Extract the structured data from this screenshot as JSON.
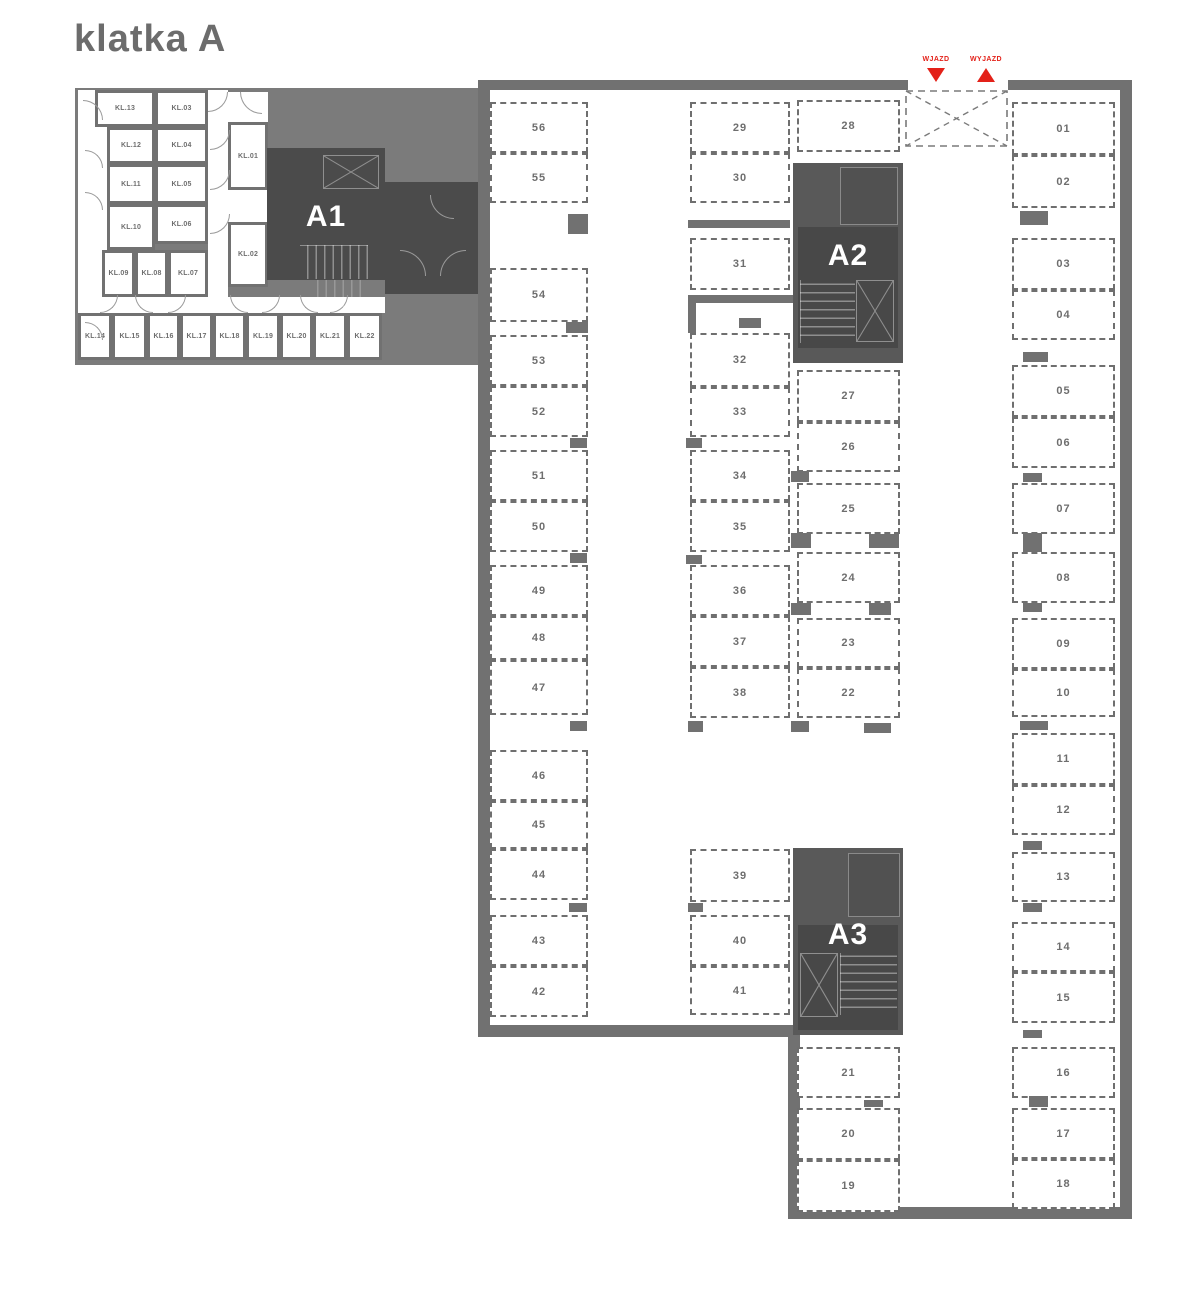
{
  "title": "klatka A",
  "colors": {
    "wall": "#717171",
    "background_region": "#7b7b7b",
    "dark_block": "#4b4b4b",
    "mid_block": "#595959",
    "label_text": "#6e6e6e",
    "accent_red": "#e32119",
    "white": "#ffffff"
  },
  "entrance": {
    "entry_label": "WJAZD",
    "exit_label": "WYJAZD"
  },
  "staircases": [
    {
      "id": "a1",
      "label": "A1"
    },
    {
      "id": "a2",
      "label": "A2"
    },
    {
      "id": "a3",
      "label": "A3"
    }
  ],
  "storage_rooms": [
    {
      "label": "KL.13",
      "x": 95,
      "y": 90,
      "w": 60,
      "h": 37
    },
    {
      "label": "KL.03",
      "x": 155,
      "y": 90,
      "w": 53,
      "h": 37
    },
    {
      "label": "KL.12",
      "x": 107,
      "y": 127,
      "w": 48,
      "h": 37
    },
    {
      "label": "KL.04",
      "x": 155,
      "y": 127,
      "w": 53,
      "h": 37
    },
    {
      "label": "KL.11",
      "x": 107,
      "y": 164,
      "w": 48,
      "h": 40
    },
    {
      "label": "KL.05",
      "x": 155,
      "y": 164,
      "w": 53,
      "h": 40
    },
    {
      "label": "KL.10",
      "x": 107,
      "y": 204,
      "w": 48,
      "h": 46
    },
    {
      "label": "KL.06",
      "x": 155,
      "y": 204,
      "w": 53,
      "h": 40
    },
    {
      "label": "KL.09",
      "x": 102,
      "y": 250,
      "w": 33,
      "h": 47
    },
    {
      "label": "KL.08",
      "x": 135,
      "y": 250,
      "w": 33,
      "h": 47
    },
    {
      "label": "KL.07",
      "x": 168,
      "y": 250,
      "w": 40,
      "h": 47
    },
    {
      "label": "KL.01",
      "x": 228,
      "y": 122,
      "w": 40,
      "h": 68
    },
    {
      "label": "KL.02",
      "x": 228,
      "y": 222,
      "w": 40,
      "h": 65
    },
    {
      "label": "KL.14",
      "x": 78,
      "y": 313,
      "w": 34,
      "h": 47
    },
    {
      "label": "KL.15",
      "x": 112,
      "y": 313,
      "w": 35,
      "h": 47
    },
    {
      "label": "KL.16",
      "x": 147,
      "y": 313,
      "w": 33,
      "h": 47
    },
    {
      "label": "KL.17",
      "x": 180,
      "y": 313,
      "w": 33,
      "h": 47
    },
    {
      "label": "KL.18",
      "x": 213,
      "y": 313,
      "w": 33,
      "h": 47
    },
    {
      "label": "KL.19",
      "x": 246,
      "y": 313,
      "w": 34,
      "h": 47
    },
    {
      "label": "KL.20",
      "x": 280,
      "y": 313,
      "w": 33,
      "h": 47
    },
    {
      "label": "KL.21",
      "x": 313,
      "y": 313,
      "w": 34,
      "h": 47
    },
    {
      "label": "KL.22",
      "x": 347,
      "y": 313,
      "w": 35,
      "h": 47
    }
  ],
  "parking_spaces": [
    {
      "label": "56",
      "x": 490,
      "y": 102,
      "w": 98,
      "h": 51
    },
    {
      "label": "55",
      "x": 490,
      "y": 153,
      "w": 98,
      "h": 50
    },
    {
      "label": "54",
      "x": 490,
      "y": 268,
      "w": 98,
      "h": 54
    },
    {
      "label": "53",
      "x": 490,
      "y": 335,
      "w": 98,
      "h": 51
    },
    {
      "label": "52",
      "x": 490,
      "y": 386,
      "w": 98,
      "h": 51
    },
    {
      "label": "51",
      "x": 490,
      "y": 450,
      "w": 98,
      "h": 51
    },
    {
      "label": "50",
      "x": 490,
      "y": 501,
      "w": 98,
      "h": 51
    },
    {
      "label": "49",
      "x": 490,
      "y": 565,
      "w": 98,
      "h": 51
    },
    {
      "label": "48",
      "x": 490,
      "y": 616,
      "w": 98,
      "h": 44
    },
    {
      "label": "47",
      "x": 490,
      "y": 660,
      "w": 98,
      "h": 55
    },
    {
      "label": "46",
      "x": 490,
      "y": 750,
      "w": 98,
      "h": 51
    },
    {
      "label": "45",
      "x": 490,
      "y": 801,
      "w": 98,
      "h": 48
    },
    {
      "label": "44",
      "x": 490,
      "y": 849,
      "w": 98,
      "h": 51
    },
    {
      "label": "43",
      "x": 490,
      "y": 915,
      "w": 98,
      "h": 51
    },
    {
      "label": "42",
      "x": 490,
      "y": 966,
      "w": 98,
      "h": 51
    },
    {
      "label": "29",
      "x": 690,
      "y": 102,
      "w": 100,
      "h": 51
    },
    {
      "label": "30",
      "x": 690,
      "y": 153,
      "w": 100,
      "h": 50
    },
    {
      "label": "31",
      "x": 690,
      "y": 238,
      "w": 100,
      "h": 52
    },
    {
      "label": "32",
      "x": 690,
      "y": 333,
      "w": 100,
      "h": 54
    },
    {
      "label": "33",
      "x": 690,
      "y": 387,
      "w": 100,
      "h": 50
    },
    {
      "label": "34",
      "x": 690,
      "y": 450,
      "w": 100,
      "h": 51
    },
    {
      "label": "35",
      "x": 690,
      "y": 501,
      "w": 100,
      "h": 51
    },
    {
      "label": "36",
      "x": 690,
      "y": 565,
      "w": 100,
      "h": 51
    },
    {
      "label": "37",
      "x": 690,
      "y": 616,
      "w": 100,
      "h": 51
    },
    {
      "label": "38",
      "x": 690,
      "y": 667,
      "w": 100,
      "h": 51
    },
    {
      "label": "39",
      "x": 690,
      "y": 849,
      "w": 100,
      "h": 53
    },
    {
      "label": "40",
      "x": 690,
      "y": 915,
      "w": 100,
      "h": 51
    },
    {
      "label": "41",
      "x": 690,
      "y": 966,
      "w": 100,
      "h": 49
    },
    {
      "label": "28",
      "x": 797,
      "y": 100,
      "w": 103,
      "h": 52
    },
    {
      "label": "27",
      "x": 797,
      "y": 370,
      "w": 103,
      "h": 52
    },
    {
      "label": "26",
      "x": 797,
      "y": 422,
      "w": 103,
      "h": 50
    },
    {
      "label": "25",
      "x": 797,
      "y": 483,
      "w": 103,
      "h": 51
    },
    {
      "label": "24",
      "x": 797,
      "y": 552,
      "w": 103,
      "h": 51
    },
    {
      "label": "23",
      "x": 797,
      "y": 618,
      "w": 103,
      "h": 50
    },
    {
      "label": "22",
      "x": 797,
      "y": 668,
      "w": 103,
      "h": 50
    },
    {
      "label": "21",
      "x": 797,
      "y": 1047,
      "w": 103,
      "h": 51
    },
    {
      "label": "20",
      "x": 797,
      "y": 1108,
      "w": 103,
      "h": 52
    },
    {
      "label": "19",
      "x": 797,
      "y": 1160,
      "w": 103,
      "h": 52
    },
    {
      "label": "01",
      "x": 1012,
      "y": 102,
      "w": 103,
      "h": 53
    },
    {
      "label": "02",
      "x": 1012,
      "y": 155,
      "w": 103,
      "h": 53
    },
    {
      "label": "03",
      "x": 1012,
      "y": 238,
      "w": 103,
      "h": 52
    },
    {
      "label": "04",
      "x": 1012,
      "y": 290,
      "w": 103,
      "h": 50
    },
    {
      "label": "05",
      "x": 1012,
      "y": 365,
      "w": 103,
      "h": 52
    },
    {
      "label": "06",
      "x": 1012,
      "y": 417,
      "w": 103,
      "h": 51
    },
    {
      "label": "07",
      "x": 1012,
      "y": 483,
      "w": 103,
      "h": 51
    },
    {
      "label": "08",
      "x": 1012,
      "y": 552,
      "w": 103,
      "h": 51
    },
    {
      "label": "09",
      "x": 1012,
      "y": 618,
      "w": 103,
      "h": 51
    },
    {
      "label": "10",
      "x": 1012,
      "y": 669,
      "w": 103,
      "h": 48
    },
    {
      "label": "11",
      "x": 1012,
      "y": 733,
      "w": 103,
      "h": 52
    },
    {
      "label": "12",
      "x": 1012,
      "y": 785,
      "w": 103,
      "h": 50
    },
    {
      "label": "13",
      "x": 1012,
      "y": 852,
      "w": 103,
      "h": 50
    },
    {
      "label": "14",
      "x": 1012,
      "y": 922,
      "w": 103,
      "h": 50
    },
    {
      "label": "15",
      "x": 1012,
      "y": 972,
      "w": 103,
      "h": 51
    },
    {
      "label": "16",
      "x": 1012,
      "y": 1047,
      "w": 103,
      "h": 51
    },
    {
      "label": "17",
      "x": 1012,
      "y": 1108,
      "w": 103,
      "h": 51
    },
    {
      "label": "18",
      "x": 1012,
      "y": 1159,
      "w": 103,
      "h": 50
    }
  ],
  "geometry": {
    "gray_regions": [
      [
        75,
        88,
        413,
        277
      ]
    ],
    "corridors": [
      [
        78,
        90,
        30,
        223
      ],
      [
        208,
        90,
        20,
        223
      ],
      [
        78,
        297,
        307,
        16
      ],
      [
        228,
        92,
        40,
        30
      ],
      [
        228,
        190,
        40,
        32
      ]
    ],
    "walls": [
      [
        478,
        80,
        430,
        10
      ],
      [
        1008,
        80,
        124,
        10
      ],
      [
        478,
        80,
        12,
        957
      ],
      [
        478,
        1025,
        322,
        12
      ],
      [
        788,
        1025,
        12,
        194
      ],
      [
        788,
        1207,
        344,
        12
      ],
      [
        1120,
        80,
        12,
        1139
      ],
      [
        688,
        220,
        102,
        8
      ],
      [
        688,
        295,
        107,
        8
      ],
      [
        688,
        295,
        8,
        38
      ]
    ],
    "pillars": [
      [
        568,
        214,
        20,
        20
      ],
      [
        566,
        322,
        22,
        11
      ],
      [
        570,
        438,
        17,
        10
      ],
      [
        570,
        553,
        17,
        10
      ],
      [
        570,
        721,
        17,
        10
      ],
      [
        569,
        903,
        18,
        9
      ],
      [
        739,
        318,
        22,
        10
      ],
      [
        686,
        438,
        16,
        10
      ],
      [
        686,
        555,
        16,
        9
      ],
      [
        688,
        721,
        15,
        11
      ],
      [
        688,
        903,
        15,
        9
      ],
      [
        791,
        721,
        18,
        11
      ],
      [
        864,
        723,
        27,
        10
      ],
      [
        791,
        471,
        18,
        11
      ],
      [
        791,
        533,
        20,
        15
      ],
      [
        869,
        534,
        30,
        14
      ],
      [
        791,
        603,
        20,
        12
      ],
      [
        869,
        603,
        22,
        12
      ],
      [
        864,
        1100,
        19,
        7
      ],
      [
        1020,
        211,
        28,
        14
      ],
      [
        1023,
        352,
        25,
        10
      ],
      [
        1023,
        473,
        19,
        9
      ],
      [
        1023,
        533,
        19,
        19
      ],
      [
        1023,
        603,
        19,
        9
      ],
      [
        1020,
        721,
        28,
        9
      ],
      [
        1023,
        841,
        19,
        9
      ],
      [
        1023,
        903,
        19,
        9
      ],
      [
        1023,
        1030,
        19,
        8
      ],
      [
        1029,
        1096,
        19,
        11
      ]
    ],
    "dark_annex": [
      385,
      182,
      98,
      112
    ],
    "arcs": [
      {
        "x": 208,
        "y": 92,
        "s": 20,
        "q": "br"
      },
      {
        "x": 240,
        "y": 92,
        "s": 22,
        "q": "bl"
      },
      {
        "x": 83,
        "y": 100,
        "s": 20,
        "q": "tr"
      },
      {
        "x": 85,
        "y": 150,
        "s": 18,
        "q": "tr"
      },
      {
        "x": 85,
        "y": 192,
        "s": 18,
        "q": "tr"
      },
      {
        "x": 85,
        "y": 322,
        "s": 18,
        "q": "tr"
      },
      {
        "x": 210,
        "y": 130,
        "s": 20,
        "q": "br"
      },
      {
        "x": 210,
        "y": 170,
        "s": 20,
        "q": "br"
      },
      {
        "x": 210,
        "y": 214,
        "s": 20,
        "q": "br"
      },
      {
        "x": 100,
        "y": 295,
        "s": 18,
        "q": "br"
      },
      {
        "x": 135,
        "y": 295,
        "s": 18,
        "q": "bl"
      },
      {
        "x": 168,
        "y": 295,
        "s": 18,
        "q": "br"
      },
      {
        "x": 230,
        "y": 295,
        "s": 18,
        "q": "bl"
      },
      {
        "x": 262,
        "y": 295,
        "s": 18,
        "q": "br"
      },
      {
        "x": 300,
        "y": 295,
        "s": 18,
        "q": "bl"
      },
      {
        "x": 330,
        "y": 295,
        "s": 18,
        "q": "br"
      },
      {
        "x": 400,
        "y": 250,
        "s": 26,
        "q": "tr"
      },
      {
        "x": 440,
        "y": 250,
        "s": 26,
        "q": "tl"
      },
      {
        "x": 430,
        "y": 195,
        "s": 24,
        "q": "bl"
      },
      {
        "x": 845,
        "y": 190,
        "s": 26,
        "q": "bl"
      },
      {
        "x": 858,
        "y": 228,
        "s": 28,
        "q": "tl"
      },
      {
        "x": 852,
        "y": 862,
        "s": 26,
        "q": "br"
      },
      {
        "x": 858,
        "y": 900,
        "s": 26,
        "q": "tl"
      }
    ]
  }
}
